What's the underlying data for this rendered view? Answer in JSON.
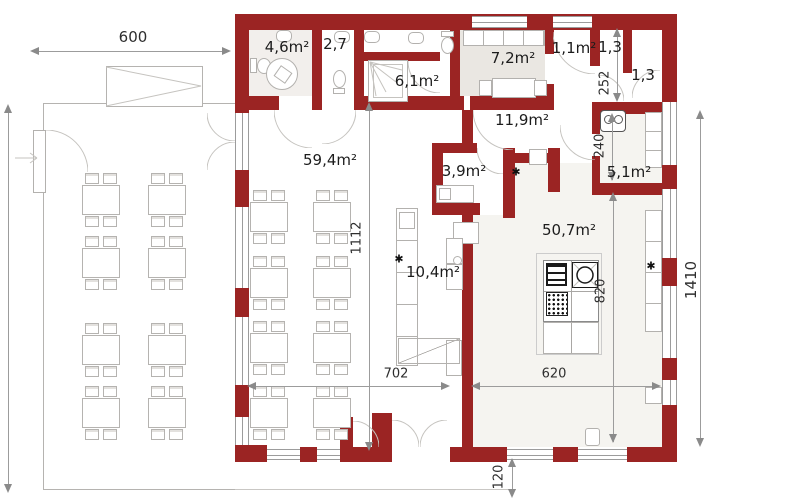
{
  "plan": {
    "room_labels": [
      {
        "name": "wc-accessible",
        "text": "4,6m²"
      },
      {
        "name": "wc",
        "text": "2,7"
      },
      {
        "name": "shower-room",
        "text": "6,1m²"
      },
      {
        "name": "office",
        "text": "7,2m²"
      },
      {
        "name": "vestibule",
        "text": "1,1m²"
      },
      {
        "name": "wc-small-left",
        "text": "1,3"
      },
      {
        "name": "wc-small-right",
        "text": "1,3"
      },
      {
        "name": "hallway",
        "text": "11,9m²"
      },
      {
        "name": "prep-room",
        "text": "3,9m²"
      },
      {
        "name": "dining-room",
        "text": "59,4m²"
      },
      {
        "name": "pantry",
        "text": "5,1m²"
      },
      {
        "name": "kitchen",
        "text": "50,7m²"
      },
      {
        "name": "bar",
        "text": "10,4m²"
      }
    ],
    "dimensions": [
      {
        "name": "overall-width-top",
        "text": "600"
      },
      {
        "name": "overall-height-right",
        "text": "1410"
      },
      {
        "name": "dining-depth",
        "text": "1112"
      },
      {
        "name": "bottom-width-left",
        "text": "702"
      },
      {
        "name": "bottom-width-right",
        "text": "620"
      },
      {
        "name": "entry-offset",
        "text": "120"
      },
      {
        "name": "wc-depth",
        "text": "252"
      },
      {
        "name": "pantry-depth",
        "text": "240"
      },
      {
        "name": "kitchen-depth",
        "text": "820"
      }
    ],
    "symbols": {
      "utility_marker": "✱"
    }
  }
}
